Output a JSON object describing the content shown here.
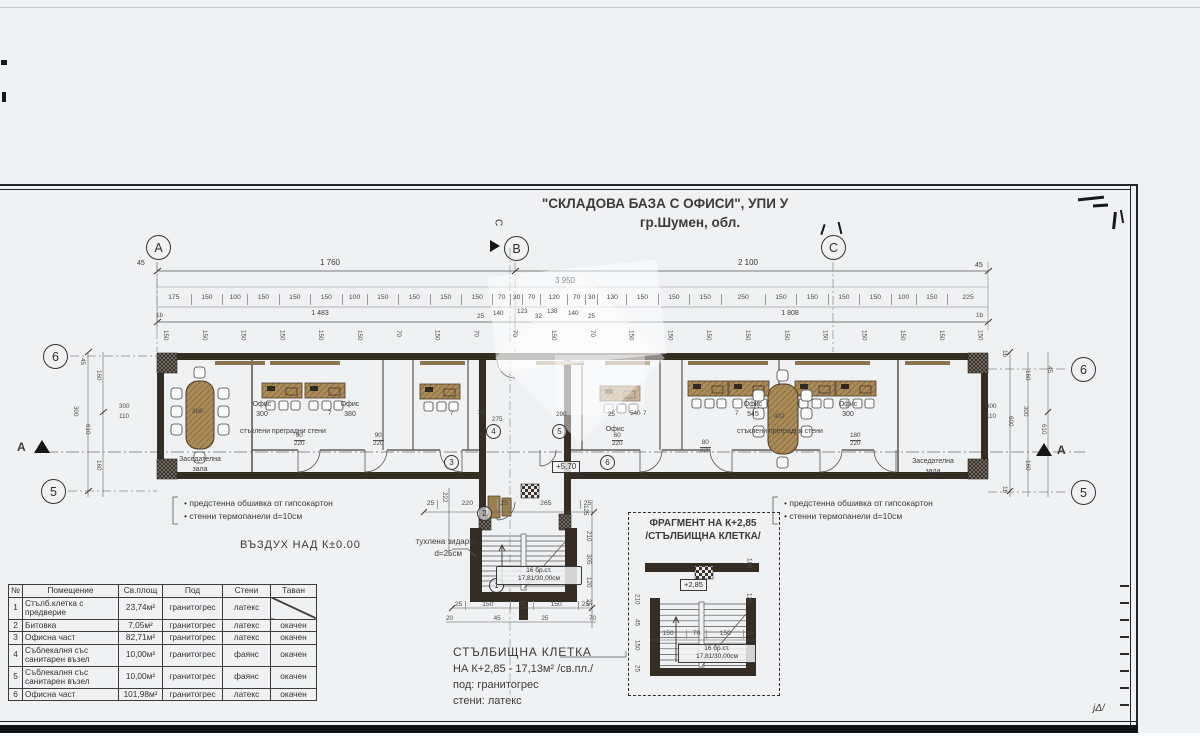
{
  "title": {
    "line1": "\"СКЛАДОВА БАЗА С ОФИСИ\", УПИ У",
    "line2": "гр.Шумен, обл."
  },
  "axes": {
    "a": "А",
    "b": "В",
    "c": "С",
    "n6": "6",
    "n5": "5",
    "section_a": "А",
    "section_c": "С"
  },
  "dims": {
    "n45": "45",
    "span_left": "1 760",
    "span_right": "2 100",
    "span_total": "3 950",
    "segments": [
      "175",
      "150",
      "100",
      "150",
      "150",
      "150",
      "100",
      "150",
      "150",
      "150",
      "150",
      "70",
      "30",
      "70",
      "120",
      "70",
      "30",
      "130",
      "150",
      "150",
      "150",
      "250",
      "150",
      "150",
      "150",
      "150",
      "100",
      "150",
      "225"
    ],
    "sub1483": "1 483",
    "sub1808": "1 808",
    "sub25": "25",
    "sub140": "140",
    "sub123": "123",
    "sub32": "32",
    "sub138": "138",
    "n1b": "1b",
    "top_rotated": [
      "150",
      "150",
      "150",
      "150",
      "150",
      "150",
      "70",
      "150",
      "70",
      "70",
      "150",
      "70",
      "150",
      "150",
      "150",
      "150",
      "150",
      "150",
      "150",
      "150",
      "150",
      "150"
    ],
    "n160": "160",
    "n300": "300",
    "n610": "610",
    "n600": "600",
    "inner300": "300",
    "inner110": "110"
  },
  "plan": {
    "office": "Офис",
    "o1": "300",
    "o2": "380",
    "o3": "540",
    "o4": "545",
    "o5": "300",
    "hall1": "Заседателна",
    "hall2": "зала",
    "t386": "386",
    "t402": "402",
    "glass": "стъклени преградни стени",
    "elev": "+5,70",
    "d275": "275",
    "d290": "290",
    "d25": "25",
    "d7": "7",
    "d90": "90",
    "d60": "60",
    "d80": "80",
    "d180": "180",
    "d220": "220",
    "c1": "1",
    "c2": "2",
    "c3": "3",
    "c4": "4",
    "c5": "5",
    "c6": "6"
  },
  "notes": {
    "wall1": "предстенна обшивка от гипсокартон",
    "wall2": "стенни термопанели d=10см",
    "air": "ВЪЗДУХ НАД К±0.00",
    "masonry1": "тухлена зидария",
    "masonry2": "d=25см",
    "stair1": "СТЪЛБИЩНА КЛЕТКА",
    "stair2": "НА К+2,85 - 17,13м² /св.пл./",
    "stair3": "под: гранитогрес",
    "stair4": "стени: латекс"
  },
  "stair": {
    "steps": "16 бр.ст.",
    "tread": "17,81/30,00см",
    "dims_top": [
      "25",
      "220",
      "25",
      "265",
      "25"
    ],
    "d222": "222",
    "d125": "125",
    "d210": "210",
    "d305": "305",
    "d120": "120",
    "d25": "25",
    "dims_b1": [
      "25",
      "150",
      "70",
      "150",
      "25"
    ],
    "dims_b2": [
      "20",
      "45",
      "25",
      "70"
    ]
  },
  "fragment": {
    "title1": "ФРАГМЕНТ НА К+2,85",
    "title2": "/СТЪЛБИЩНА КЛЕТКА/",
    "elev": "+2,85",
    "steps": "16 бр.ст.",
    "tread": "17,81/30,00см",
    "dims_b": [
      "150",
      "70",
      "150",
      "25"
    ],
    "dims_l": [
      "210",
      "45",
      "150",
      "25"
    ],
    "dims_r": [
      "183",
      "125"
    ]
  },
  "table": {
    "headers": [
      "№",
      "Помещение",
      "Св.площ",
      "Под",
      "Стени",
      "Таван"
    ],
    "rows": [
      {
        "n": "1",
        "room": "Стълб.клетка с предверие",
        "area": "23,74м²",
        "floor": "гранитогрес",
        "walls": "латекс",
        "ceiling": ""
      },
      {
        "n": "2",
        "room": "Битовка",
        "area": "7,05м²",
        "floor": "гранитогрес",
        "walls": "латекс",
        "ceiling": "окачен"
      },
      {
        "n": "3",
        "room": "Офисна част",
        "area": "82,71м²",
        "floor": "гранитогрес",
        "walls": "латекс",
        "ceiling": "окачен"
      },
      {
        "n": "4",
        "room": "Съблекалня със санитарен възел",
        "area": "10,00м²",
        "floor": "гранитогрес",
        "walls": "фаянс",
        "ceiling": "окачен"
      },
      {
        "n": "5",
        "room": "Съблекалня със санитарен възел",
        "area": "10,00м²",
        "floor": "гранитогрес",
        "walls": "фаянс",
        "ceiling": "окачен"
      },
      {
        "n": "6",
        "room": "Офисна част",
        "area": "101,98м²",
        "floor": "гранитогрес",
        "walls": "латекс",
        "ceiling": "окачен"
      }
    ]
  },
  "page": {
    "scribble": "јΔ/"
  }
}
